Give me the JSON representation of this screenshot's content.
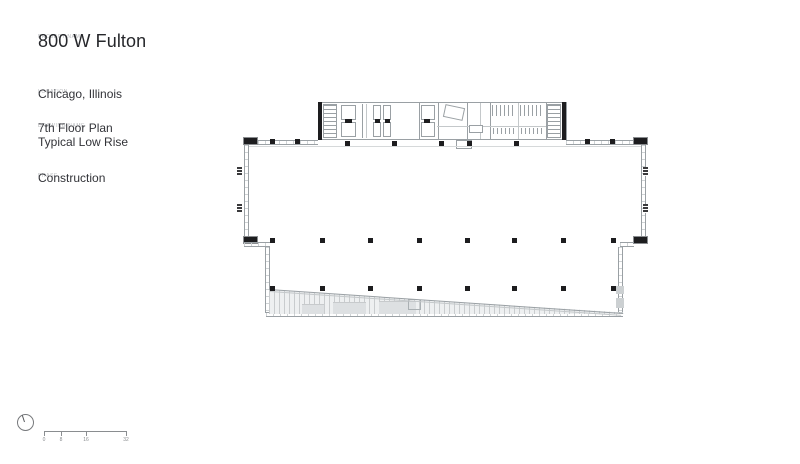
{
  "sidebar": {
    "project": {
      "label": "PROJECT NAME",
      "value": "800 W Fulton"
    },
    "location": {
      "label": "LOCATION",
      "value": "Chicago, Illinois"
    },
    "drawing": {
      "label": "DRAWING NAME",
      "line1": "7th Floor Plan",
      "line2": "Typical Low Rise"
    },
    "phase": {
      "label": "PHASE",
      "value": "Construction"
    }
  },
  "scale_bar": {
    "labels": [
      "0",
      "8",
      "16",
      "32"
    ]
  },
  "icons": {
    "north_arrow": "north-arrow-circle"
  },
  "colors": {
    "background": "#ffffff",
    "plan_line": "#9aa0a4",
    "plan_fill_black": "#1d1d1f",
    "hatch_fill": "#eef0f1",
    "text": "#2e2f33",
    "micro_label": "#b5b7ba"
  }
}
